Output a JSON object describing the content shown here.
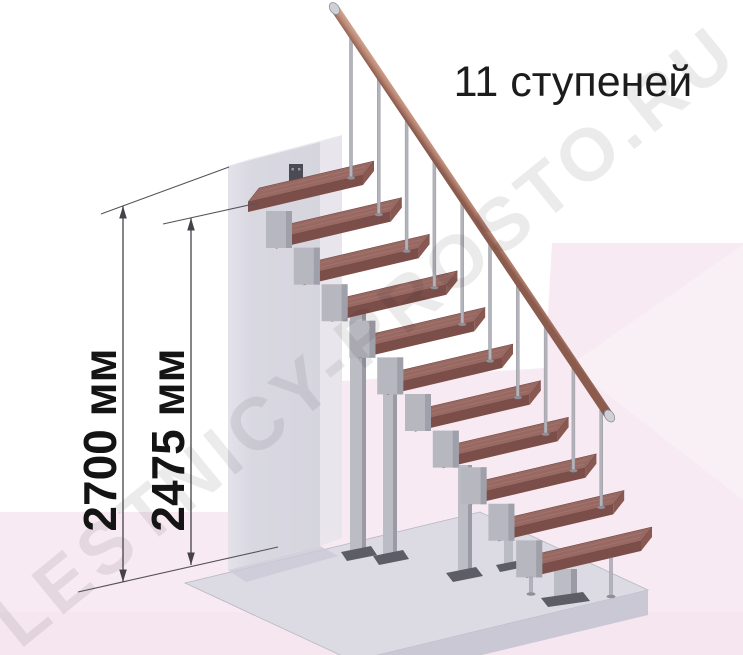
{
  "title": "11 ступеней",
  "watermark": "LESTNICY-PROSTO.RU",
  "stairs": {
    "step_count": 11
  },
  "dimensions": [
    {
      "id": "total-height",
      "label": "2700 мм"
    },
    {
      "id": "top-step-height",
      "label": "2475 мм"
    }
  ],
  "colors": {
    "text": "#1c1c1c",
    "dimension_line": "#46424a",
    "tread_top": "#986862",
    "tread_front": "#7b4e49",
    "tread_end": "#885851",
    "rail_light": "#dcb6a2",
    "rail_mid": "#bd8b77",
    "rail_dark": "#8b5b4e",
    "metal": "#b7b7c0",
    "wall_front": "#d6d5de",
    "wall_side": "#e8e6ec",
    "floor_top": "#dcdbe4",
    "floor_front": "#c9c8d4",
    "background_pink": "#f7eaf2",
    "watermark_gray": "#e9e6e9"
  }
}
